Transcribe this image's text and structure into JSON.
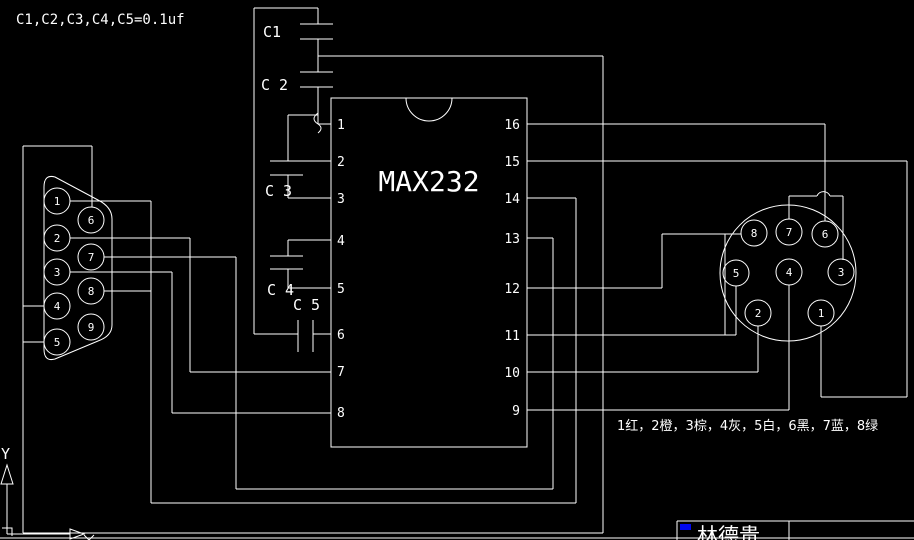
{
  "note": "C1,C2,C3,C4,C5=0.1uf",
  "chip": {
    "label": "MAX232",
    "left_pins": [
      "1",
      "2",
      "3",
      "4",
      "5",
      "6",
      "7",
      "8"
    ],
    "right_pins": [
      "16",
      "15",
      "14",
      "13",
      "12",
      "11",
      "10",
      "9"
    ]
  },
  "capacitors": [
    "C1",
    "C 2",
    "C 3",
    "C 4",
    "C 5"
  ],
  "db9_pins": [
    "1",
    "2",
    "3",
    "4",
    "5",
    "6",
    "7",
    "8",
    "9"
  ],
  "din_pins": [
    "8",
    "7",
    "6",
    "5",
    "4",
    "3",
    "2",
    "1"
  ],
  "legend": "1红，2橙，3棕，4灰，5白，6黑，7蓝，8绿",
  "title_block": {
    "name": "林德贵"
  },
  "ucs": {
    "y_label": "Y"
  },
  "colors": {
    "background": "#000000",
    "line": "#ffffff",
    "accent": "#0008ee"
  }
}
